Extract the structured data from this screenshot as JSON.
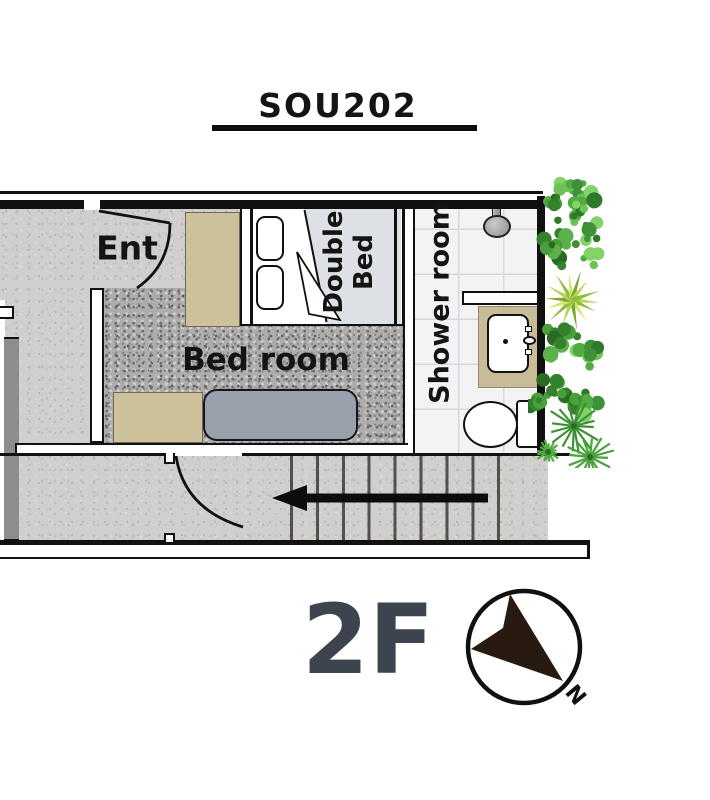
{
  "title": {
    "unit": "SOU202"
  },
  "floor": {
    "label": "2F"
  },
  "compass": {
    "north_label": "N"
  },
  "rooms": {
    "entrance": {
      "label": "Ent"
    },
    "bedroom": {
      "label": "Bed room"
    },
    "double_bed": {
      "label": "Double Bed"
    },
    "shower_room": {
      "label": "Shower room"
    }
  },
  "colors": {
    "wall": "#111111",
    "floor_concrete": "#d0cfcd",
    "carpet_gray": "#aeadab",
    "tile_white": "#f3f3f5",
    "wood_tan": "#cdc19c",
    "sofa_gray": "#9aa0ab",
    "bed_blanket": "#dde0e4",
    "floor_label_text": "#3d4450",
    "plant_green": "#4da53e",
    "arrow_black": "#111111"
  }
}
